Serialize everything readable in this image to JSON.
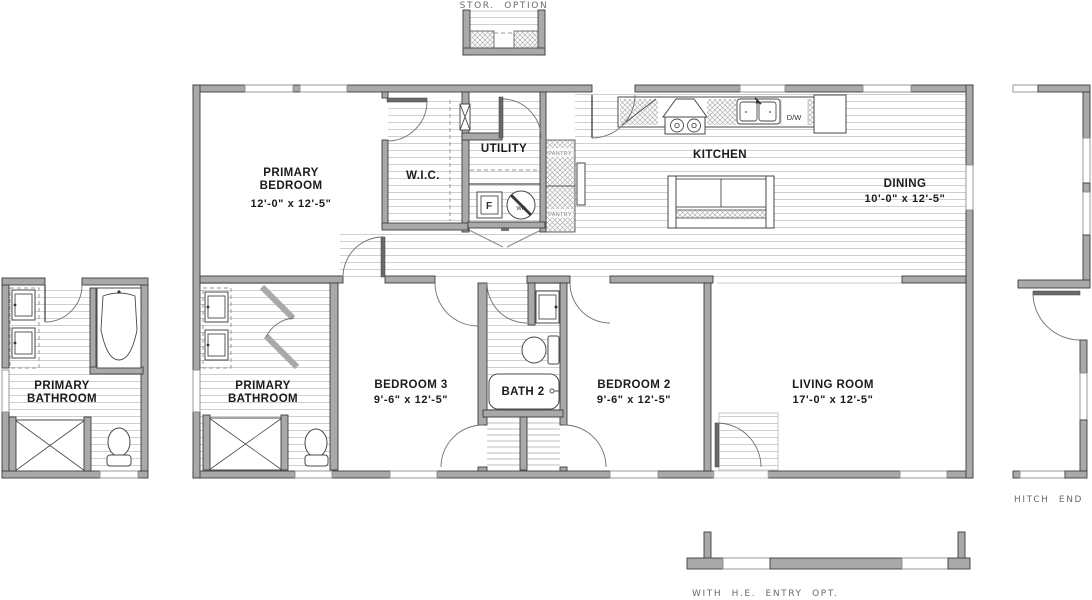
{
  "options": {
    "storage": "STOR. OPTION",
    "hitch_end": "HITCH END OPT.",
    "he_entry": "WITH H.E. ENTRY OPT."
  },
  "rooms": {
    "primary_bedroom": {
      "line1": "PRIMARY",
      "line2": "BEDROOM",
      "dims": "12'-0\" x  12'-5\""
    },
    "wic": {
      "name": "W.I.C."
    },
    "utility": {
      "name": "UTILITY"
    },
    "kitchen": {
      "name": "KITCHEN"
    },
    "dining": {
      "name": "DINING",
      "dims": "10'-0\" x  12'-5\""
    },
    "primary_bathroom_option": {
      "line1": "PRIMARY",
      "line2": "BATHROOM"
    },
    "primary_bathroom": {
      "line1": "PRIMARY",
      "line2": "BATHROOM"
    },
    "bedroom3": {
      "name": "BEDROOM 3",
      "dims": "9'-6\" x  12'-5\""
    },
    "bath2": {
      "name": "BATH 2"
    },
    "bedroom2": {
      "name": "BEDROOM 2",
      "dims": "9'-6\" x  12'-5\""
    },
    "living_room": {
      "name": "LIVING ROOM",
      "dims": "17'-0\" x  12'-5\""
    }
  },
  "fixtures": {
    "pantry_upper": "PANTRY",
    "pantry_lower": "PANTRY",
    "dishwasher": "D/W",
    "furnace": "F",
    "water_heater": "WH"
  },
  "colors": {
    "wall_fill": "#a9a9a9",
    "wall_stroke": "#3d3d3d",
    "floor_line": "#c9c9c9",
    "room_label": "#1b1b1b",
    "option_label": "#6b6b6b"
  }
}
